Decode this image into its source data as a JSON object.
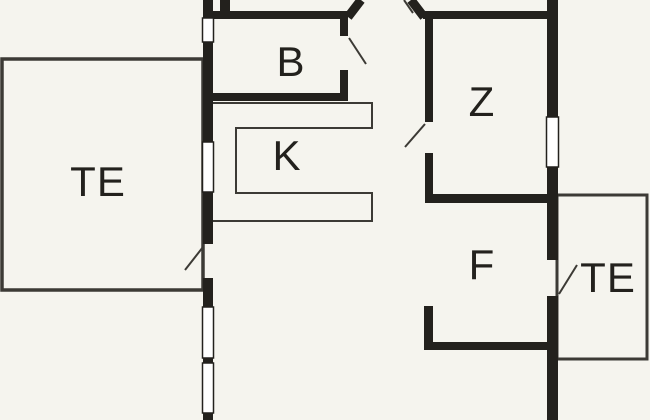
{
  "page": {
    "title": "Floor plan",
    "canvas_width": 650,
    "canvas_height": 420
  },
  "colors": {
    "background": "#f5f4ee",
    "wall": "#23211d",
    "thin_line": "#3c3a35",
    "window_fill": "#ffffff",
    "label_text": "#23211d"
  },
  "plan": {
    "rooms": [
      {
        "id": "terrace-left",
        "label": "TE",
        "cx": 98,
        "cy": 182
      },
      {
        "id": "room-b",
        "label": "B",
        "cx": 291,
        "cy": 62
      },
      {
        "id": "kitchen-k",
        "label": "K",
        "cx": 287,
        "cy": 156
      },
      {
        "id": "room-z",
        "label": "Z",
        "cx": 482,
        "cy": 102
      },
      {
        "id": "room-f",
        "label": "F",
        "cx": 482,
        "cy": 265
      },
      {
        "id": "terrace-right",
        "label": "TE",
        "cx": 608,
        "cy": 278
      }
    ],
    "walls": [
      {
        "name": "left-exterior-wall-seg-1",
        "x": 203,
        "y": 0,
        "w": 10,
        "h": 18
      },
      {
        "name": "left-exterior-wall-seg-2",
        "x": 203,
        "y": 42,
        "w": 10,
        "h": 100
      },
      {
        "name": "left-exterior-wall-seg-3",
        "x": 203,
        "y": 192,
        "w": 10,
        "h": 52
      },
      {
        "name": "left-exterior-wall-seg-4",
        "x": 203,
        "y": 278,
        "w": 10,
        "h": 29
      },
      {
        "name": "left-wall-window-divider",
        "x": 203,
        "y": 358,
        "w": 10,
        "h": 5
      },
      {
        "name": "left-exterior-wall-seg-5",
        "x": 203,
        "y": 413,
        "w": 10,
        "h": 7
      },
      {
        "name": "top-wall-stub",
        "x": 220,
        "y": 0,
        "w": 10,
        "h": 19
      },
      {
        "name": "top-wall-left-segment",
        "x": 203,
        "y": 11,
        "w": 145,
        "h": 8
      },
      {
        "name": "room-b-right-wall-upper",
        "x": 340,
        "y": 19,
        "w": 8,
        "h": 17
      },
      {
        "name": "room-b-right-wall-lower",
        "x": 340,
        "y": 70,
        "w": 8,
        "h": 31
      },
      {
        "name": "room-b-bottom-wall",
        "x": 203,
        "y": 93,
        "w": 145,
        "h": 8
      },
      {
        "name": "top-wall-right-segment",
        "x": 423,
        "y": 11,
        "w": 135,
        "h": 8
      },
      {
        "name": "room-z-left-wall-upper",
        "x": 425,
        "y": 19,
        "w": 8,
        "h": 103
      },
      {
        "name": "room-z-left-wall-lower",
        "x": 425,
        "y": 153,
        "w": 8,
        "h": 50
      },
      {
        "name": "room-z-bottom-wall",
        "x": 425,
        "y": 194,
        "w": 133,
        "h": 9
      },
      {
        "name": "right-exterior-wall-seg-1",
        "x": 547,
        "y": 0,
        "w": 11,
        "h": 117
      },
      {
        "name": "right-exterior-wall-seg-2",
        "x": 547,
        "y": 167,
        "w": 11,
        "h": 93
      },
      {
        "name": "right-exterior-wall-seg-3",
        "x": 547,
        "y": 296,
        "w": 11,
        "h": 124
      },
      {
        "name": "room-f-partition-vertical",
        "x": 424,
        "y": 306,
        "w": 9,
        "h": 44
      },
      {
        "name": "room-f-partition-horizontal",
        "x": 424,
        "y": 342,
        "w": 134,
        "h": 8
      }
    ],
    "thick_diagonals": [
      {
        "name": "entry-angled-wall-left",
        "x1": 348,
        "y1": 17,
        "x2": 361,
        "y2": 0,
        "width": 9
      },
      {
        "name": "entry-angled-wall-right",
        "x1": 411,
        "y1": 0,
        "x2": 424,
        "y2": 17,
        "width": 9
      }
    ],
    "windows": [
      {
        "name": "left-wall-window-1",
        "x": 202.5,
        "y": 18,
        "w": 11,
        "h": 24
      },
      {
        "name": "left-wall-window-2",
        "x": 202.5,
        "y": 142,
        "w": 11,
        "h": 50
      },
      {
        "name": "left-wall-window-3",
        "x": 202.5,
        "y": 307,
        "w": 11,
        "h": 51
      },
      {
        "name": "left-wall-window-4",
        "x": 202.5,
        "y": 363,
        "w": 11,
        "h": 50
      },
      {
        "name": "right-wall-window-1",
        "x": 546.5,
        "y": 117,
        "w": 12,
        "h": 50
      }
    ],
    "door_swings": [
      {
        "name": "room-b-door-swing",
        "x1": 349,
        "y1": 38,
        "x2": 366,
        "y2": 64
      },
      {
        "name": "room-z-door-swing",
        "x1": 425,
        "y1": 124,
        "x2": 405,
        "y2": 147
      },
      {
        "name": "terrace-left-door-swing",
        "x1": 203,
        "y1": 247,
        "x2": 185,
        "y2": 270
      },
      {
        "name": "terrace-right-door-swing",
        "x1": 559,
        "y1": 294,
        "x2": 577,
        "y2": 265
      },
      {
        "name": "entry-door-swing",
        "x1": 404,
        "y1": 0,
        "x2": 413,
        "y2": 13
      }
    ],
    "terrace_outlines": [
      {
        "name": "terrace-left-outline",
        "x": 2,
        "y": 59,
        "w": 201,
        "h": 231,
        "stroke": 3.5
      },
      {
        "name": "terrace-right-outline",
        "x": 557,
        "y": 195,
        "w": 90,
        "h": 164,
        "stroke": 3
      }
    ],
    "kitchen_counter": {
      "name": "kitchen-counter-outline",
      "path": "M213,103 H372 V128 H236 V193 H372 V221 H213",
      "stroke": 2
    }
  }
}
